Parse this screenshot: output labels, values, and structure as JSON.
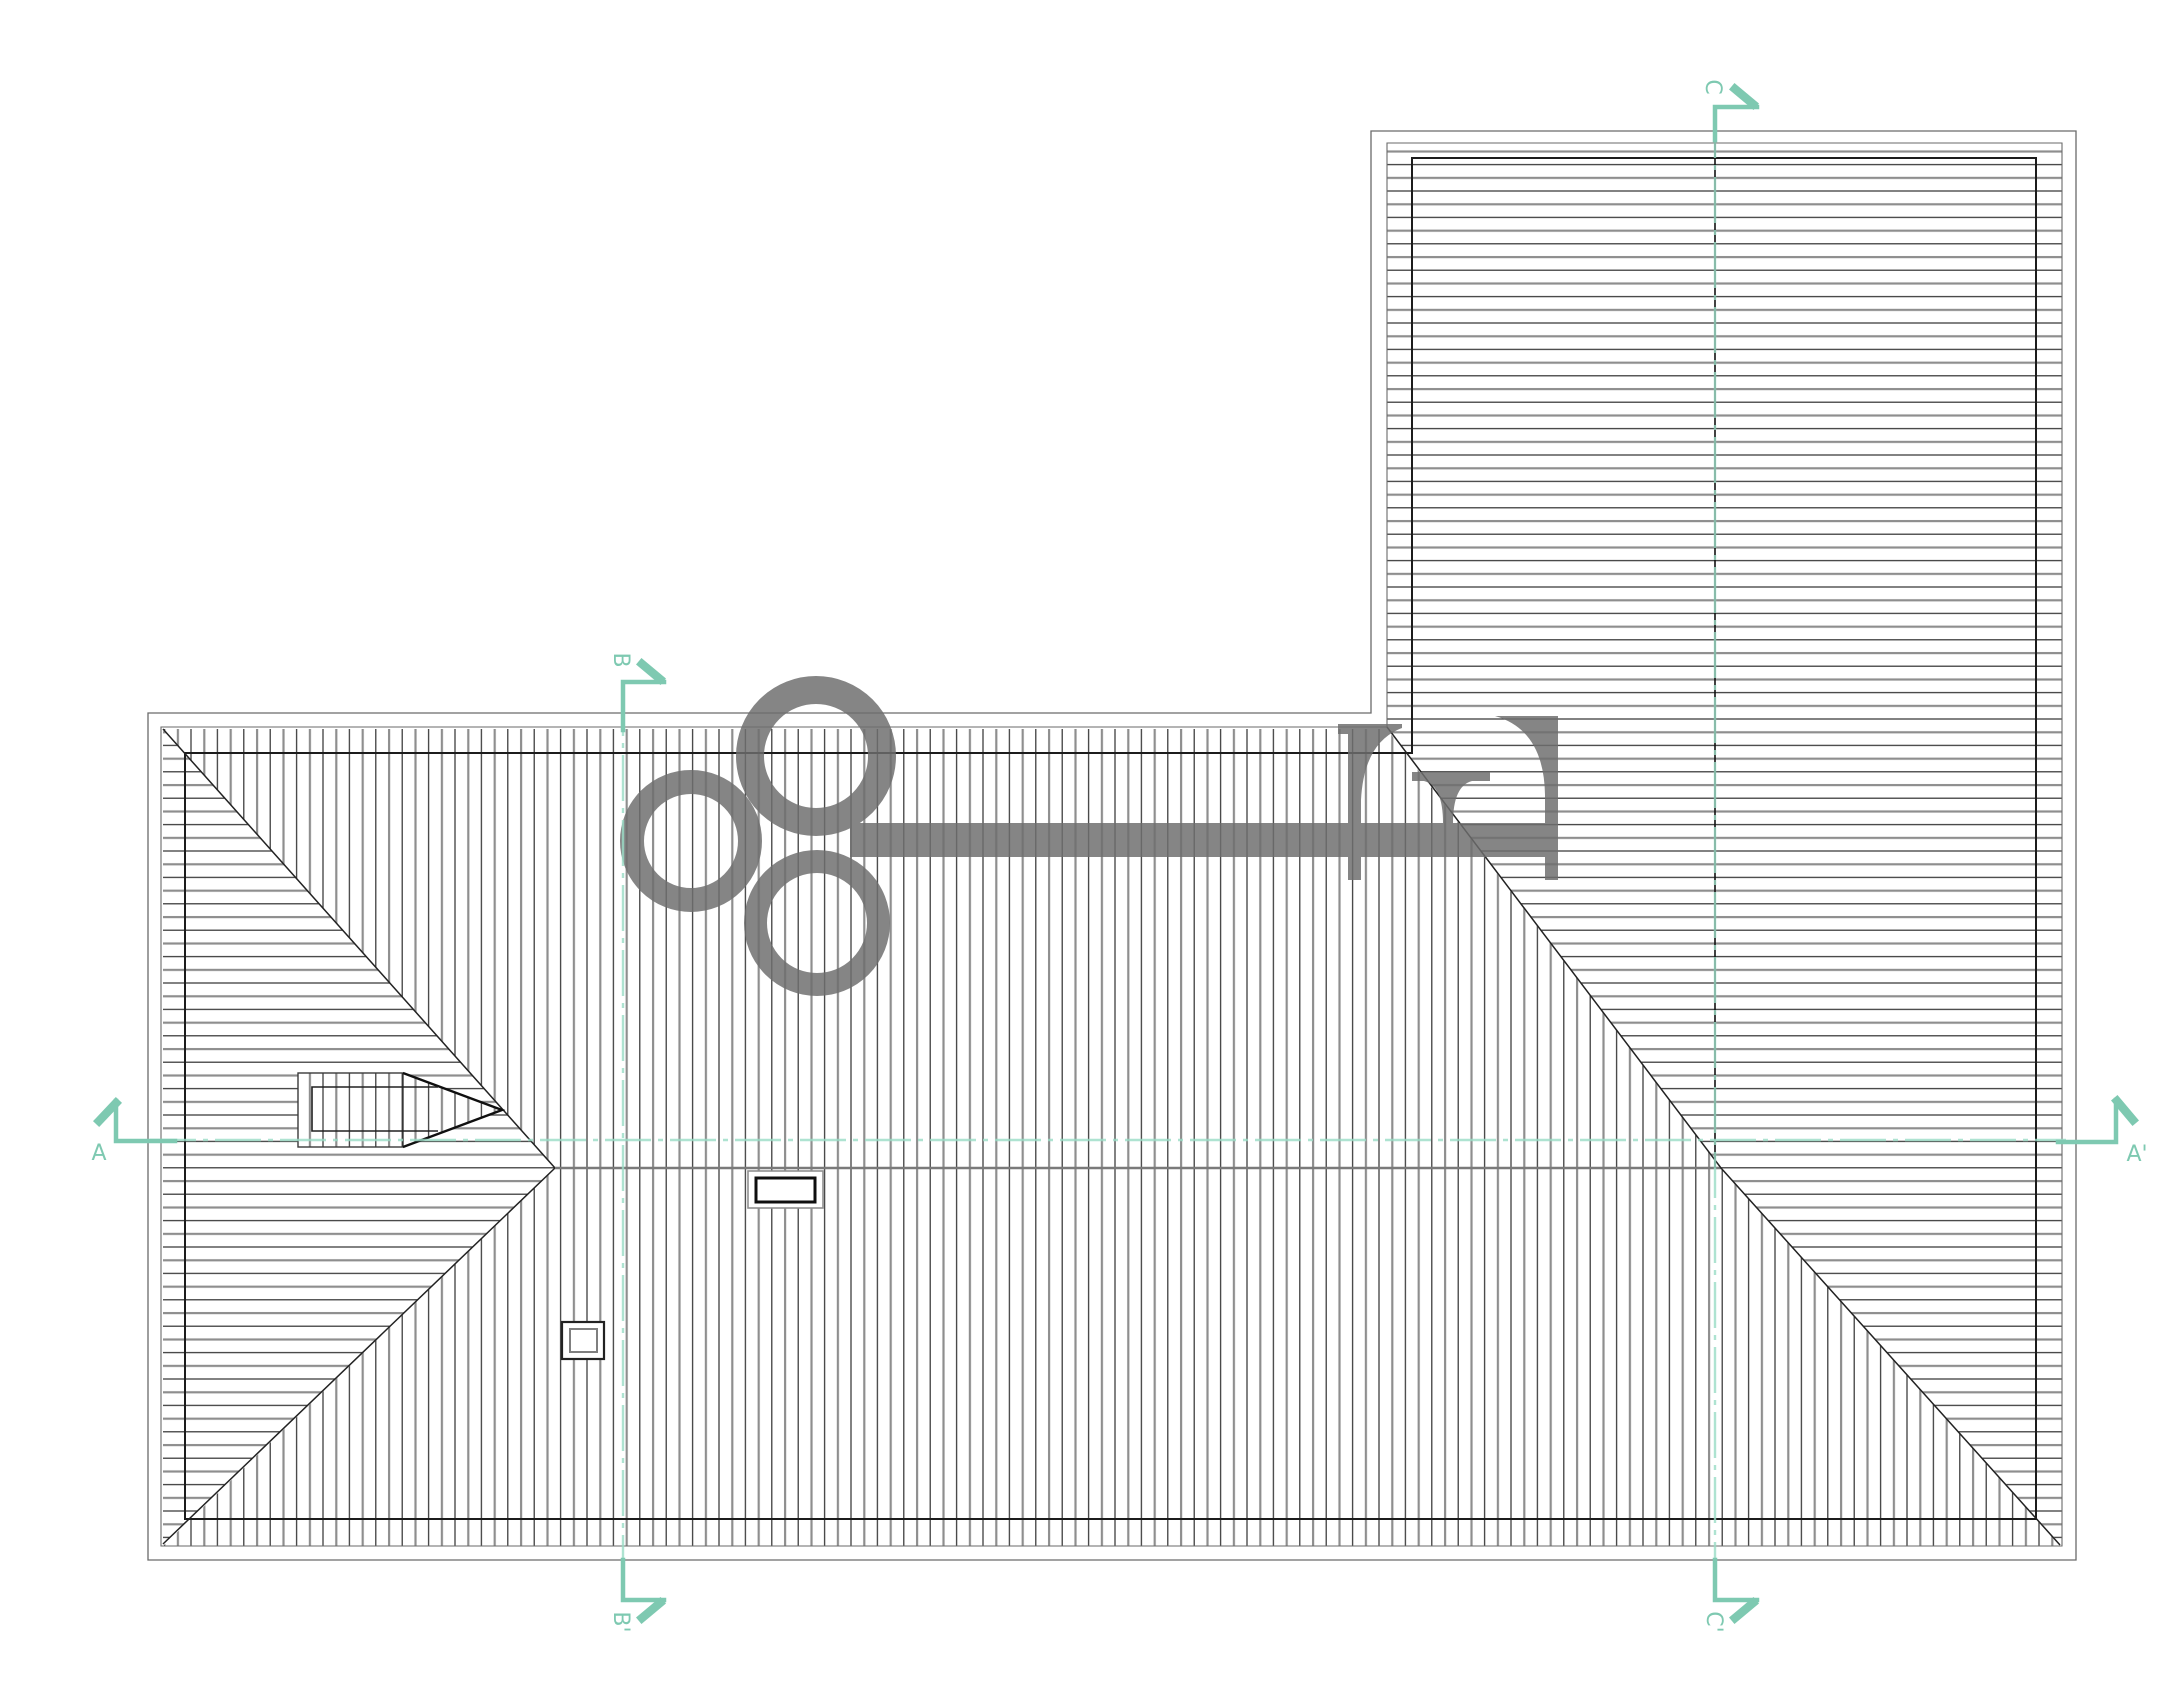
{
  "drawing": {
    "title": "roof-plan",
    "description": "Architectural roof plan of an L-shaped building with hip and valley lines, hatched roof planes, a dormer, chimney, roof vent and a gray key-shaped watermark. Section cut lines A-A', B-B', C-C' are drawn in teal."
  },
  "markers": {
    "a": {
      "label": "A"
    },
    "a_prime": {
      "label": "A'"
    },
    "b": {
      "label": "B"
    },
    "b_prime": {
      "label": "B'"
    },
    "c": {
      "label": "C"
    },
    "c_prime": {
      "label": "C'"
    }
  },
  "colors": {
    "teal": "#7ec9b1",
    "teal_line": "#9adcc6",
    "key_gray": "#6e6e6e",
    "line_dark": "#1c1c1c",
    "line_mid": "#6a6a6a",
    "hatch_dark": "#2e2e2e",
    "hatch_light": "#8e8e8e",
    "paper": "#ffffff"
  }
}
